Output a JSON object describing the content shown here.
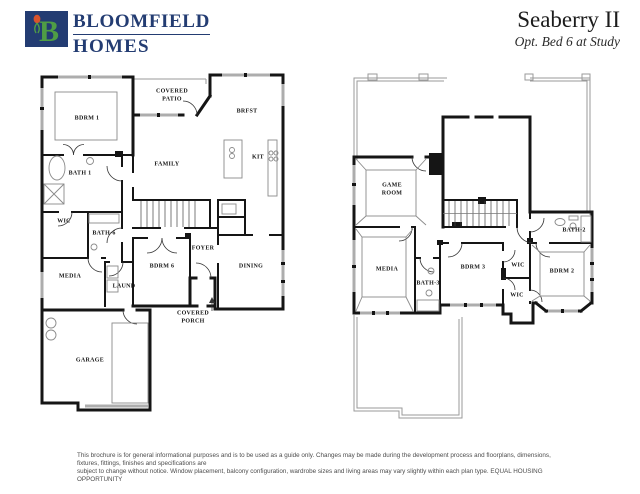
{
  "header": {
    "brand": {
      "logo_letter": "B",
      "line1": "BLOOMFIELD",
      "line2": "HOMES"
    },
    "plan_name": "Seaberry II",
    "plan_option": "Opt. Bed 6 at Study"
  },
  "colors": {
    "brand_navy": "#233c72",
    "logo_green": "#4f9d45",
    "tulip_red": "#d9532c",
    "wall_black": "#151515",
    "window_gray": "#adadad",
    "roof_gray": "#9a9a9a"
  },
  "floorplans": {
    "first_floor": {
      "rooms": {
        "bdrm1": "BDRM 1",
        "covered_patio": "COVERED\nPATIO",
        "brfst": "BRFST",
        "kit": "KIT",
        "family": "FAMILY",
        "bath1": "BATH 1",
        "wic": "WIC",
        "bath6": "BATH-6",
        "media": "MEDIA",
        "laund": "LAUND",
        "bdrm6": "BDRM 6",
        "foyer": "FOYER",
        "dining": "DINING",
        "covered_porch": "COVERED\nPORCH",
        "garage": "GARAGE"
      }
    },
    "second_floor": {
      "rooms": {
        "game_room": "GAME\nROOM",
        "media": "MEDIA",
        "bath3": "BATH-3",
        "bdrm3": "BDRM 3",
        "wic_upper": "WIC",
        "wic_lower": "WIC",
        "bath2": "BATH-2",
        "bdrm2": "BDRM 2"
      }
    }
  },
  "footer": {
    "line1": "This brochure is for general informational purposes and is to be used as a guide only. Changes may be made during the development process and floorplans, dimensions, fixtures, fittings, finishes and specifications are",
    "line2": "subject to change without notice. Window placement, balcony configuration, wardrobe sizes and living areas may vary slightly within each plan type.  EQUAL HOUSING OPPORTUNITY"
  }
}
